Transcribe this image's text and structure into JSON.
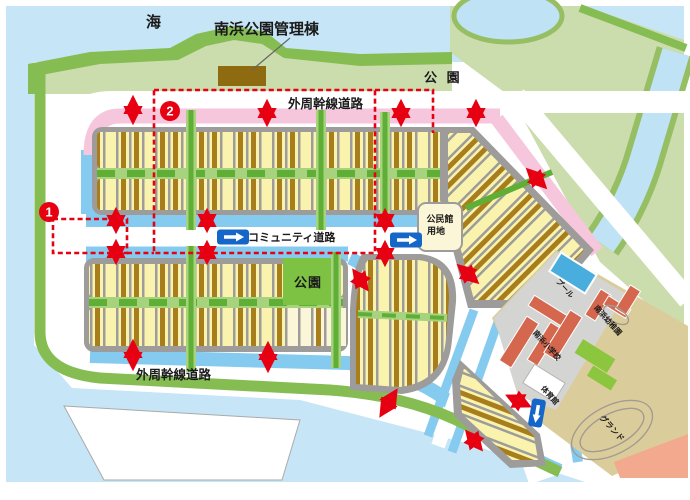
{
  "labels": {
    "sea": "海",
    "management_building": "南浜公園管理棟",
    "park_top": "公 園",
    "park_mid": "公園",
    "outer_road_top": "外周幹線道路",
    "outer_road_bottom": "外周幹線道路",
    "community_road": "コミュニティ道路",
    "community_hall_line1": "公民館",
    "community_hall_line2": "用地",
    "school": "南浜小学校",
    "kindergarten": "南浜幼稚園",
    "pool": "プール",
    "gym": "体育館",
    "ground": "グランド",
    "badge1": "1",
    "badge2": "2"
  },
  "colors": {
    "sea": "#C6E5F6",
    "waterStrip": "#85CBF0",
    "river": "#BFE2F4",
    "olive": "#96BE62",
    "shoreDark": "#86BD53",
    "parkLight": "#CBDCAD",
    "parkBright": "#7DC242",
    "greenDark": "#5FAE35",
    "greenLight": "#A8D37E",
    "lotYellow": "#FAF3AE",
    "lotCream": "#FCF6D8",
    "buildingBrown": "#A87E1C",
    "mgmtBrown": "#8E6B10",
    "blockGray": "#9D9C9A",
    "pink": "#F6C7DC",
    "red": "#E60012",
    "signBlue": "#1467C8",
    "schoolPave": "#D4D4D2",
    "schoolBldg": "#D4674E",
    "pool": "#49AEDE",
    "ground": "#DBCD9B",
    "lawn": "#8CC63F",
    "salmon": "#F2A98E",
    "trackLine": "#A39A90"
  }
}
